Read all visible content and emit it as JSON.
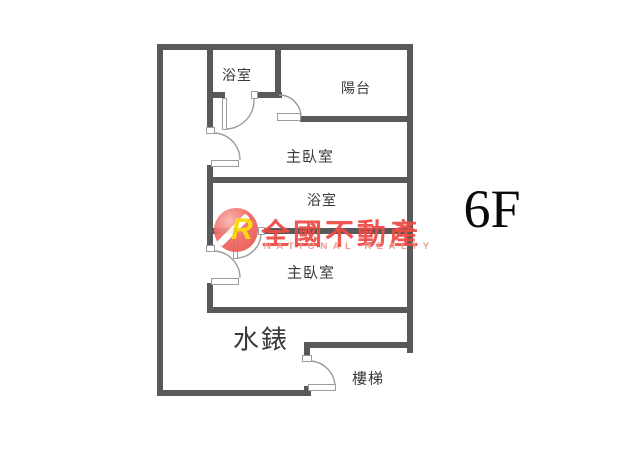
{
  "floor_label": "6F",
  "watermark": {
    "logo_letter": "R",
    "brand": "全國不動產",
    "brand_sub": "NATIONAL REALTY"
  },
  "rooms": {
    "bathroom_top": "浴室",
    "balcony": "陽台",
    "master_top": "主臥室",
    "bathroom_mid": "浴室",
    "master_mid": "主臥室",
    "water_meter": "水錶",
    "stairs": "樓梯"
  },
  "colors": {
    "wall": "#58595b",
    "door": "#9c9c9c",
    "label": "#3a3a3a",
    "brand_red": "#ee4a44",
    "brand_pink": "#f1928c",
    "logo_yellow": "#ffd600"
  }
}
